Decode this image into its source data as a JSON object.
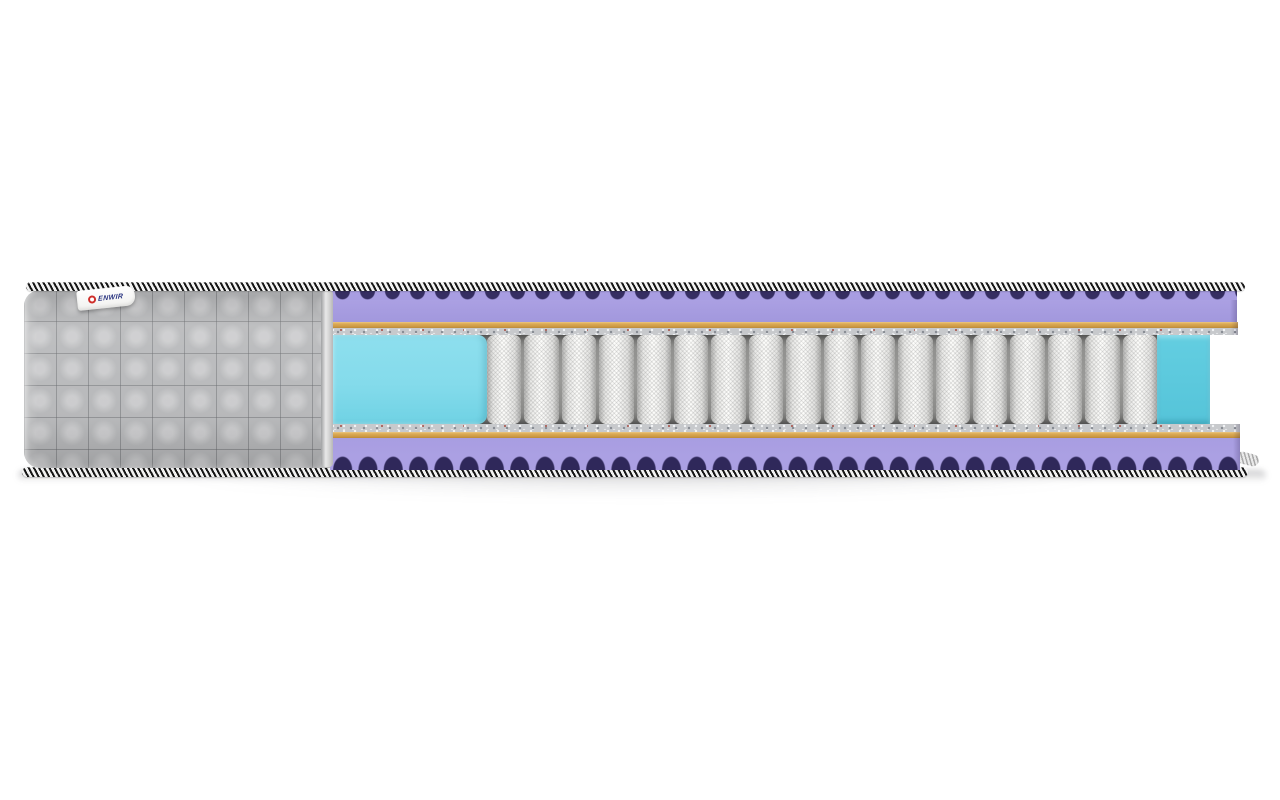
{
  "scene": {
    "type": "product-render",
    "subject": "Mattress cutaway cross-section showing internal construction layers",
    "background_color": "#ffffff"
  },
  "brand_tag": {
    "text": "ENWIR",
    "logo": "red-ring-logo",
    "tag_color": "#ffffff",
    "text_color": "#26317f",
    "logo_color": "#cf2f2b"
  },
  "layers": [
    {
      "id": "border-tape-top",
      "name": "black-white zigzag border tape (top edge)",
      "colors": [
        "#161616",
        "#f2f2f2"
      ]
    },
    {
      "id": "quilted-cover",
      "name": "gray quilted fabric cover (uncut left section)",
      "color": "#b5b6b8"
    },
    {
      "id": "wave-foam-top",
      "name": "lilac egg-crate wave foam layer (top)",
      "color": "#a89de1",
      "valley_shadow_color": "#362e62"
    },
    {
      "id": "spunbond-top",
      "name": "tan spunbond sheet (top)",
      "color": "#d7a54e"
    },
    {
      "id": "felt-top",
      "name": "speckled felt pad (top)",
      "color": "#c7c9cc"
    },
    {
      "id": "edge-foam-left",
      "name": "cyan edge-support foam (left block, front face)",
      "color": "#85dcec"
    },
    {
      "id": "pocket-springs",
      "name": "independent pocket spring coils (white fabric pockets)",
      "color": "#f2f2f0",
      "gap_color": "#8a8a88",
      "count": 18
    },
    {
      "id": "edge-foam-right",
      "name": "cyan edge-support foam (right block, cut face)",
      "color": "#58c6da"
    },
    {
      "id": "felt-bottom",
      "name": "speckled felt pad (bottom)",
      "color": "#c7c9cc"
    },
    {
      "id": "spunbond-bottom",
      "name": "tan spunbond sheet (bottom)",
      "color": "#d7a54e"
    },
    {
      "id": "wave-foam-bottom",
      "name": "lilac egg-crate wave foam layer (bottom)",
      "color": "#aba0e3",
      "valley_shadow_color": "#2f285a"
    },
    {
      "id": "border-tape-bottom",
      "name": "black-white zigzag border tape (bottom edge)",
      "colors": [
        "#161616",
        "#f2f2f2"
      ]
    }
  ]
}
